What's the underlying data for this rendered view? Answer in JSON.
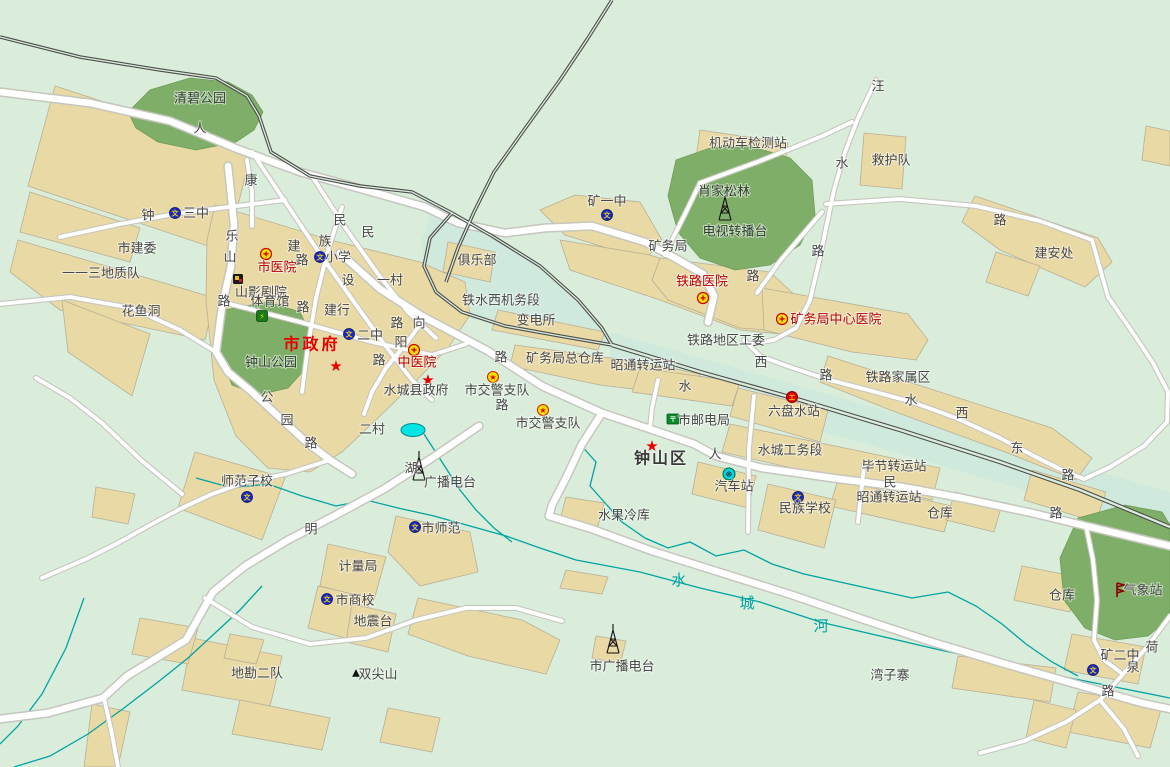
{
  "map": {
    "colors": {
      "background": "#d9edda",
      "rail_zone": "#cfe9dd",
      "building": "#e9d9a4",
      "building_outline": "#b7b098",
      "park": "#7fae68",
      "road_fill": "#ffffff",
      "road_casing": "#c6c6bf",
      "railway": "#4c4c4c",
      "river": "#00a3a3",
      "lake": "#00e4e4",
      "label": "#474747",
      "hospital_red": "#b80000",
      "government_red": "#e60000"
    },
    "labels": [
      {
        "text": "清碧公园",
        "x": 200,
        "y": 99,
        "kind": "park"
      },
      {
        "text": "人",
        "x": 200,
        "y": 129,
        "kind": "road"
      },
      {
        "text": "康",
        "x": 251,
        "y": 181,
        "kind": "road"
      },
      {
        "text": "钟",
        "x": 148,
        "y": 216,
        "kind": "road"
      },
      {
        "text": "三中",
        "x": 196,
        "y": 214,
        "kind": "poi"
      },
      {
        "text": "市建委",
        "x": 137,
        "y": 249,
        "kind": "poi"
      },
      {
        "text": "一一三地质队",
        "x": 101,
        "y": 274,
        "kind": "poi"
      },
      {
        "text": "花鱼洞",
        "x": 141,
        "y": 312,
        "kind": "poi"
      },
      {
        "text": "乐",
        "x": 232,
        "y": 237,
        "kind": "road"
      },
      {
        "text": "山",
        "x": 230,
        "y": 258,
        "kind": "road"
      },
      {
        "text": "路",
        "x": 224,
        "y": 302,
        "kind": "road"
      },
      {
        "text": "民",
        "x": 340,
        "y": 221,
        "kind": "road"
      },
      {
        "text": "民",
        "x": 368,
        "y": 233,
        "kind": "road"
      },
      {
        "text": "族",
        "x": 325,
        "y": 242,
        "kind": "road"
      },
      {
        "text": "建",
        "x": 294,
        "y": 247,
        "kind": "road"
      },
      {
        "text": "路",
        "x": 302,
        "y": 261,
        "kind": "road"
      },
      {
        "text": "设",
        "x": 348,
        "y": 281,
        "kind": "road"
      },
      {
        "text": "路",
        "x": 303,
        "y": 308,
        "kind": "road"
      },
      {
        "text": "小学",
        "x": 338,
        "y": 258,
        "kind": "poi"
      },
      {
        "text": "市医院",
        "x": 277,
        "y": 268,
        "kind": "red"
      },
      {
        "text": "山影剧院",
        "x": 261,
        "y": 293,
        "kind": "poi"
      },
      {
        "text": "体育馆",
        "x": 270,
        "y": 302,
        "kind": "poi"
      },
      {
        "text": "建行",
        "x": 337,
        "y": 311,
        "kind": "poi"
      },
      {
        "text": "一村",
        "x": 390,
        "y": 281,
        "kind": "poi"
      },
      {
        "text": "市政府",
        "x": 312,
        "y": 344,
        "kind": "gov"
      },
      {
        "text": "钟山公园",
        "x": 271,
        "y": 363,
        "kind": "park"
      },
      {
        "text": "二中",
        "x": 370,
        "y": 336,
        "kind": "poi"
      },
      {
        "text": "向",
        "x": 419,
        "y": 324,
        "kind": "road"
      },
      {
        "text": "路",
        "x": 397,
        "y": 324,
        "kind": "road"
      },
      {
        "text": "阳",
        "x": 401,
        "y": 343,
        "kind": "road"
      },
      {
        "text": "路",
        "x": 379,
        "y": 361,
        "kind": "road"
      },
      {
        "text": "中医院",
        "x": 417,
        "y": 363,
        "kind": "red"
      },
      {
        "text": "水城县政府",
        "x": 416,
        "y": 391,
        "kind": "poi",
        "s": 14
      },
      {
        "text": "市交警支队",
        "x": 497,
        "y": 391,
        "kind": "poi"
      },
      {
        "text": "市交警支队",
        "x": 548,
        "y": 424,
        "kind": "poi"
      },
      {
        "text": "路",
        "x": 501,
        "y": 358,
        "kind": "road"
      },
      {
        "text": "路",
        "x": 502,
        "y": 406,
        "kind": "road"
      },
      {
        "text": "二村",
        "x": 372,
        "y": 430,
        "kind": "poi"
      },
      {
        "text": "公",
        "x": 267,
        "y": 398,
        "kind": "road"
      },
      {
        "text": "园",
        "x": 287,
        "y": 421,
        "kind": "road"
      },
      {
        "text": "路",
        "x": 311,
        "y": 444,
        "kind": "road"
      },
      {
        "text": "俱乐部",
        "x": 477,
        "y": 261,
        "kind": "poi"
      },
      {
        "text": "铁水西机务段",
        "x": 501,
        "y": 301,
        "kind": "poi"
      },
      {
        "text": "变电所",
        "x": 536,
        "y": 321,
        "kind": "poi"
      },
      {
        "text": "矿务局总仓库",
        "x": 565,
        "y": 359,
        "kind": "poi"
      },
      {
        "text": "昭通转运站",
        "x": 643,
        "y": 366,
        "kind": "poi"
      },
      {
        "text": "矿一中",
        "x": 607,
        "y": 202,
        "kind": "poi"
      },
      {
        "text": "矿务局",
        "x": 668,
        "y": 247,
        "kind": "poi"
      },
      {
        "text": "肖家松林",
        "x": 724,
        "y": 192,
        "kind": "park"
      },
      {
        "text": "电视转播台",
        "x": 735,
        "y": 232,
        "kind": "park"
      },
      {
        "text": "机动车检测站",
        "x": 748,
        "y": 144,
        "kind": "poi"
      },
      {
        "text": "铁路医院",
        "x": 702,
        "y": 282,
        "kind": "red"
      },
      {
        "text": "路",
        "x": 753,
        "y": 277,
        "kind": "road"
      },
      {
        "text": "铁路地区工委",
        "x": 726,
        "y": 341,
        "kind": "poi"
      },
      {
        "text": "矿务局中心医院",
        "x": 836,
        "y": 320,
        "kind": "red"
      },
      {
        "text": "西",
        "x": 761,
        "y": 363,
        "kind": "road"
      },
      {
        "text": "路",
        "x": 826,
        "y": 376,
        "kind": "road"
      },
      {
        "text": "铁路家属区",
        "x": 898,
        "y": 378,
        "kind": "poi"
      },
      {
        "text": "水",
        "x": 911,
        "y": 401,
        "kind": "road"
      },
      {
        "text": "西",
        "x": 962,
        "y": 414,
        "kind": "road"
      },
      {
        "text": "东",
        "x": 1017,
        "y": 449,
        "kind": "road"
      },
      {
        "text": "路",
        "x": 1068,
        "y": 476,
        "kind": "road"
      },
      {
        "text": "路",
        "x": 1056,
        "y": 514,
        "kind": "road"
      },
      {
        "text": "六盘水站",
        "x": 794,
        "y": 412,
        "kind": "poi"
      },
      {
        "text": "市邮电局",
        "x": 704,
        "y": 421,
        "kind": "poi"
      },
      {
        "text": "钟山区",
        "x": 661,
        "y": 458,
        "kind": "dist"
      },
      {
        "text": "人",
        "x": 715,
        "y": 455,
        "kind": "road"
      },
      {
        "text": "水",
        "x": 685,
        "y": 387,
        "kind": "road"
      },
      {
        "text": "水城工务段",
        "x": 790,
        "y": 451,
        "kind": "poi"
      },
      {
        "text": "汽车站",
        "x": 734,
        "y": 487,
        "kind": "poi"
      },
      {
        "text": "民族学校",
        "x": 805,
        "y": 509,
        "kind": "poi"
      },
      {
        "text": "毕节转运站",
        "x": 894,
        "y": 467,
        "kind": "poi"
      },
      {
        "text": "民",
        "x": 890,
        "y": 483,
        "kind": "road"
      },
      {
        "text": "昭通转运站",
        "x": 889,
        "y": 498,
        "kind": "poi"
      },
      {
        "text": "仓库",
        "x": 940,
        "y": 514,
        "kind": "poi"
      },
      {
        "text": "仓库",
        "x": 1062,
        "y": 596,
        "kind": "poi"
      },
      {
        "text": "水果冷库",
        "x": 624,
        "y": 516,
        "kind": "poi"
      },
      {
        "text": "市师范",
        "x": 441,
        "y": 529,
        "kind": "poi"
      },
      {
        "text": "师范子校",
        "x": 247,
        "y": 482,
        "kind": "poi"
      },
      {
        "text": "湖",
        "x": 411,
        "y": 469,
        "kind": "road"
      },
      {
        "text": "广播电台",
        "x": 450,
        "y": 483,
        "kind": "poi"
      },
      {
        "text": "明",
        "x": 311,
        "y": 530,
        "kind": "road"
      },
      {
        "text": "计量局",
        "x": 358,
        "y": 567,
        "kind": "poi"
      },
      {
        "text": "市商校",
        "x": 355,
        "y": 601,
        "kind": "poi"
      },
      {
        "text": "地震台",
        "x": 373,
        "y": 622,
        "kind": "poi"
      },
      {
        "text": "地勘二队",
        "x": 257,
        "y": 674,
        "kind": "poi"
      },
      {
        "text": "双尖山",
        "x": 378,
        "y": 675,
        "kind": "poi"
      },
      {
        "text": "市广播电台",
        "x": 622,
        "y": 667,
        "kind": "poi"
      },
      {
        "text": "湾子寨",
        "x": 890,
        "y": 676,
        "kind": "poi"
      },
      {
        "text": "气象站",
        "x": 1143,
        "y": 591,
        "kind": "poi"
      },
      {
        "text": "矿二中",
        "x": 1120,
        "y": 656,
        "kind": "poi"
      },
      {
        "text": "荷",
        "x": 1152,
        "y": 648,
        "kind": "road"
      },
      {
        "text": "泉",
        "x": 1133,
        "y": 668,
        "kind": "road"
      },
      {
        "text": "路",
        "x": 1108,
        "y": 692,
        "kind": "road"
      },
      {
        "text": "救护队",
        "x": 891,
        "y": 161,
        "kind": "poi"
      },
      {
        "text": "汪",
        "x": 878,
        "y": 87,
        "kind": "road"
      },
      {
        "text": "水",
        "x": 842,
        "y": 164,
        "kind": "road"
      },
      {
        "text": "路",
        "x": 818,
        "y": 252,
        "kind": "road"
      },
      {
        "text": "路",
        "x": 1000,
        "y": 221,
        "kind": "road"
      },
      {
        "text": "建安处",
        "x": 1054,
        "y": 254,
        "kind": "poi"
      },
      {
        "text": "水",
        "x": 679,
        "y": 580,
        "kind": "river"
      },
      {
        "text": "城",
        "x": 747,
        "y": 603,
        "kind": "river"
      },
      {
        "text": "河",
        "x": 821,
        "y": 626,
        "kind": "river"
      }
    ],
    "pois": [
      {
        "icon": "school",
        "x": 175,
        "y": 213
      },
      {
        "icon": "school",
        "x": 320,
        "y": 257
      },
      {
        "icon": "school",
        "x": 349,
        "y": 334
      },
      {
        "icon": "school",
        "x": 607,
        "y": 215
      },
      {
        "icon": "school",
        "x": 798,
        "y": 497
      },
      {
        "icon": "school",
        "x": 415,
        "y": 527
      },
      {
        "icon": "school",
        "x": 247,
        "y": 497
      },
      {
        "icon": "school",
        "x": 327,
        "y": 599
      },
      {
        "icon": "school",
        "x": 1093,
        "y": 670
      },
      {
        "icon": "hospital",
        "x": 266,
        "y": 254
      },
      {
        "icon": "hospital",
        "x": 414,
        "y": 350
      },
      {
        "icon": "hospital",
        "x": 703,
        "y": 298
      },
      {
        "icon": "hospital",
        "x": 782,
        "y": 319
      },
      {
        "icon": "star",
        "x": 336,
        "y": 365
      },
      {
        "icon": "star",
        "x": 428,
        "y": 379
      },
      {
        "icon": "star",
        "x": 652,
        "y": 445
      },
      {
        "icon": "police",
        "x": 493,
        "y": 377
      },
      {
        "icon": "police",
        "x": 543,
        "y": 410
      },
      {
        "icon": "cinema",
        "x": 238,
        "y": 279
      },
      {
        "icon": "sport",
        "x": 262,
        "y": 316
      },
      {
        "icon": "tower",
        "x": 725,
        "y": 211
      },
      {
        "icon": "tower",
        "x": 419,
        "y": 471
      },
      {
        "icon": "tower",
        "x": 613,
        "y": 644
      },
      {
        "icon": "bus",
        "x": 729,
        "y": 474
      },
      {
        "icon": "post",
        "x": 673,
        "y": 419
      },
      {
        "icon": "railstation",
        "x": 792,
        "y": 397
      },
      {
        "icon": "mountain",
        "x": 356,
        "y": 673
      },
      {
        "icon": "weather",
        "x": 1117,
        "y": 590
      }
    ]
  }
}
